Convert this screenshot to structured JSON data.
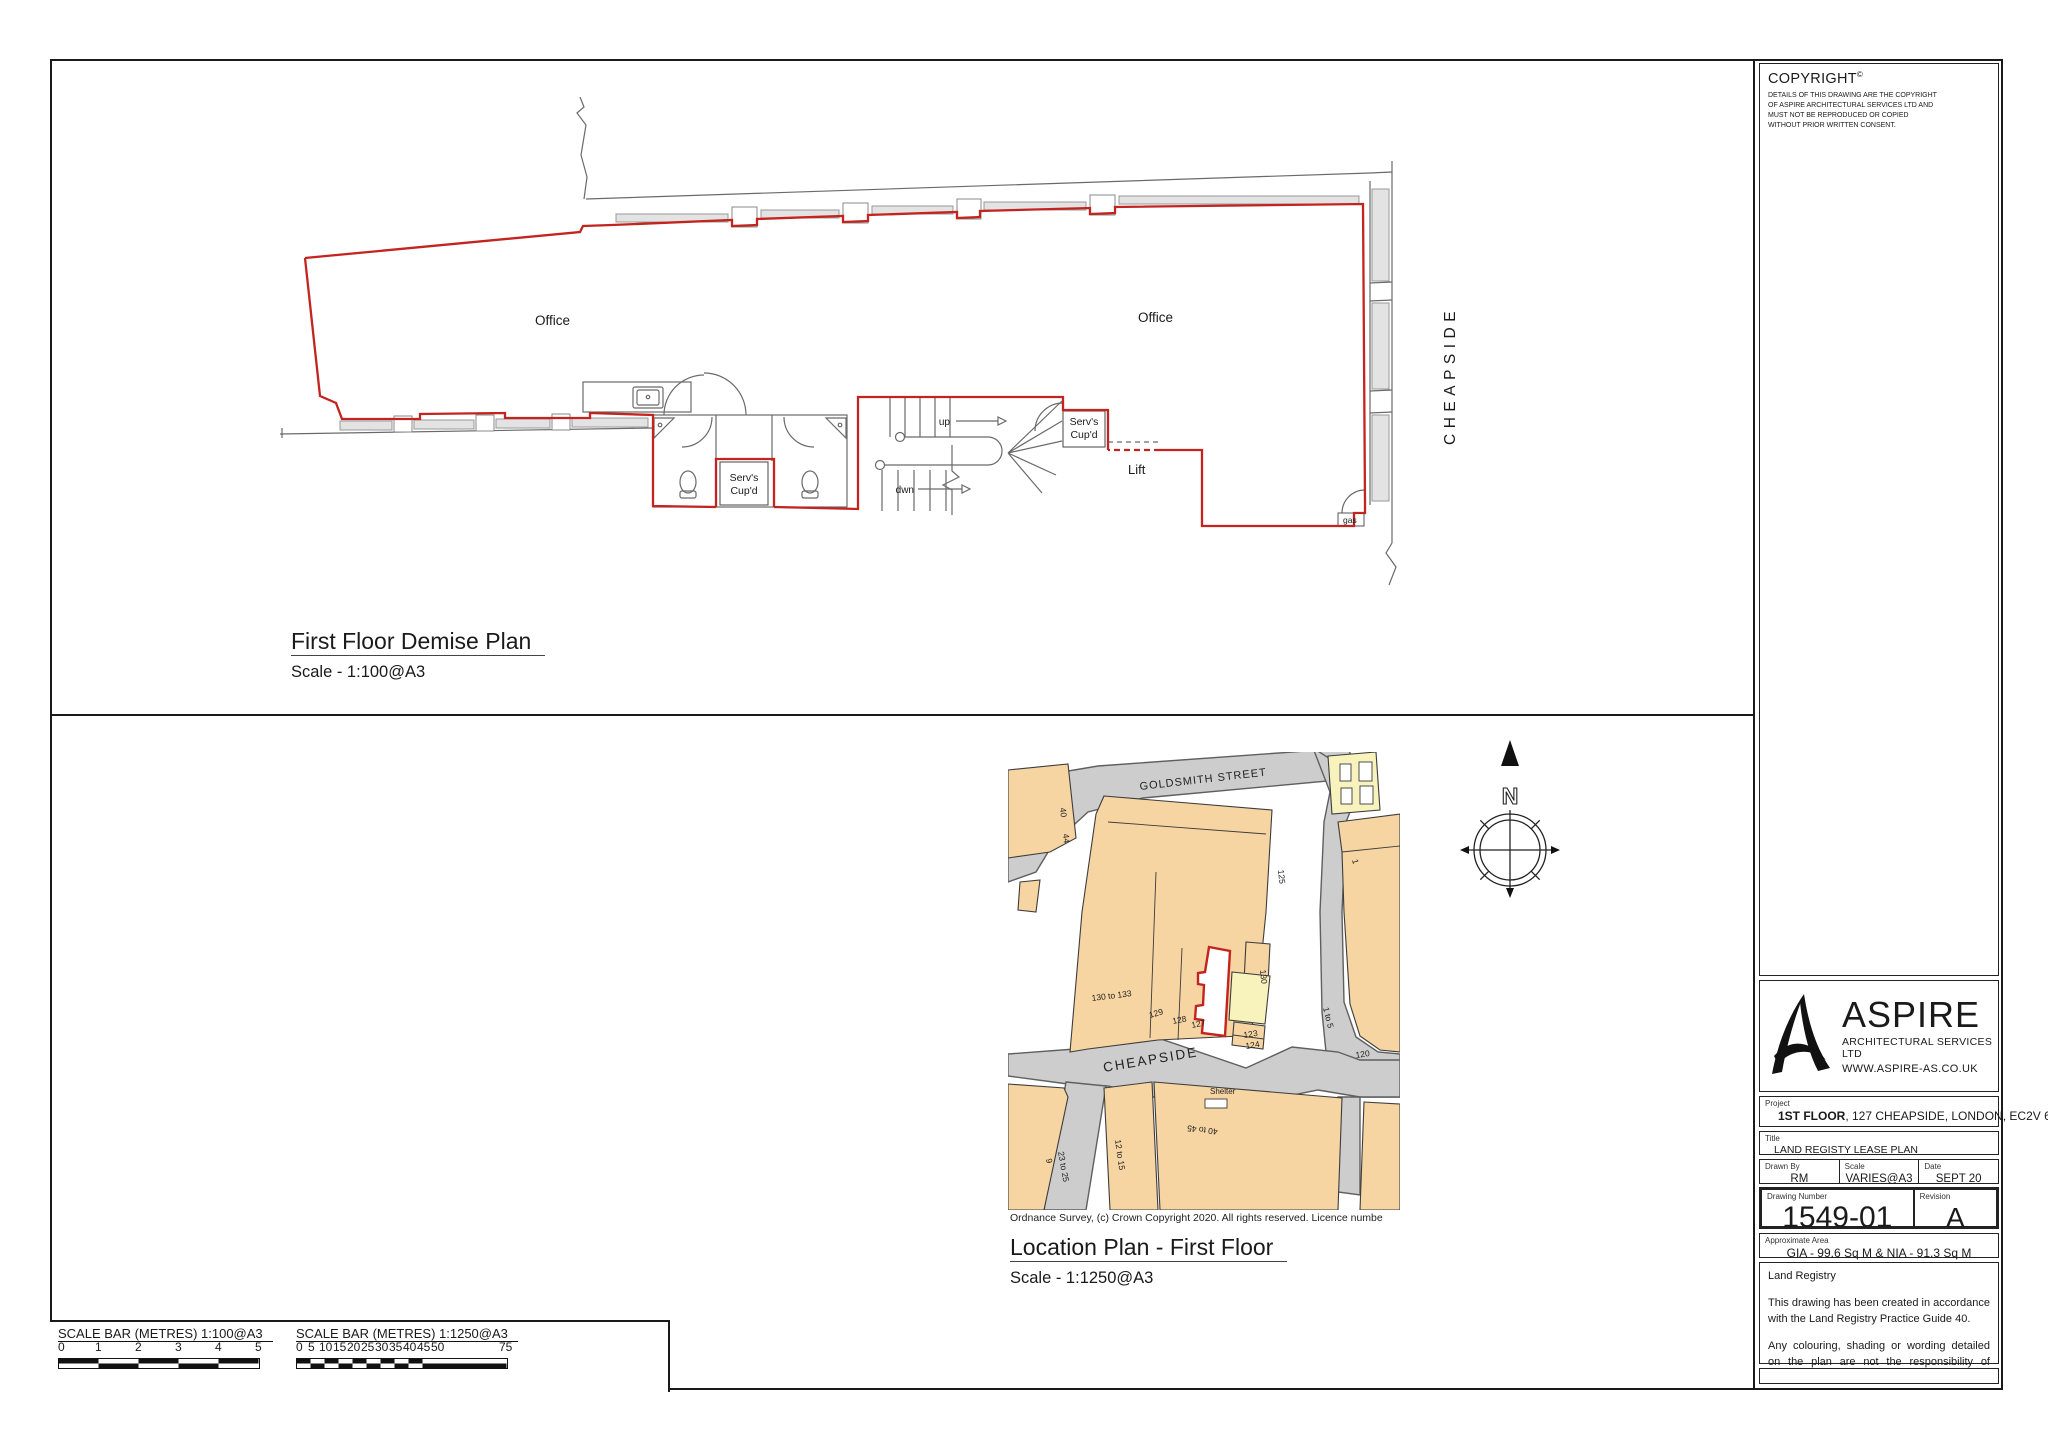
{
  "copyright": {
    "title": "COPYRIGHT",
    "sup": "©",
    "body": "DETAILS OF THIS DRAWING ARE THE COPYRIGHT OF ASPIRE ARCHITECTURAL SERVICES LTD AND MUST NOT BE REPRODUCED OR COPIED WITHOUT PRIOR WRITTEN CONSENT."
  },
  "demise_plan": {
    "title": "First Floor Demise Plan",
    "scale": "Scale - 1:100@A3",
    "labels": {
      "office_left": "Office",
      "office_right": "Office",
      "servs_left_line1": "Serv's",
      "servs_left_line2": "Cup'd",
      "servs_right_line1": "Serv's",
      "servs_right_line2": "Cup'd",
      "lift": "Lift",
      "up": "up",
      "dwn": "dwn",
      "gas": "gas",
      "street": "CHEAPSIDE"
    }
  },
  "location_plan": {
    "title": "Location Plan - First Floor",
    "scale": "Scale - 1:1250@A3",
    "credit": "Ordnance Survey, (c) Crown Copyright 2020. All rights reserved. Licence numbe",
    "north": "N",
    "streets": {
      "goldsmith": "GOLDSMITH STREET",
      "cheapside": "CHEAPSIDE"
    },
    "labels": {
      "n40": "40",
      "n44": "44",
      "n125": "125",
      "n1": "1",
      "n130": "130",
      "n130to133": "130 to 133",
      "n129": "129",
      "n128": "128",
      "n127": "127",
      "n123": "123",
      "n124": "124",
      "n1to5": "1 to 5",
      "n120": "120",
      "shelter": "Shelter",
      "n40to45": "40 to 45",
      "n12to15": "12 to 15",
      "n9": "9",
      "n23to25": "23 to 25"
    }
  },
  "title_block": {
    "logo": {
      "name": "ASPIRE",
      "subtitle": "ARCHITECTURAL SERVICES LTD",
      "website": "WWW.ASPIRE-AS.CO.UK"
    },
    "project": {
      "label": "Project",
      "bold": "1ST FLOOR",
      "rest": ", 127 CHEAPSIDE, LONDON, EC2V 6BT"
    },
    "title": {
      "label": "Title",
      "value": "LAND REGISTY LEASE PLAN"
    },
    "drawn_by": {
      "label": "Drawn By",
      "value": "RM"
    },
    "scale": {
      "label": "Scale",
      "value": "VARIES@A3"
    },
    "date": {
      "label": "Date",
      "value": "SEPT 20"
    },
    "drawing_number": {
      "label": "Drawing Number",
      "value": "1549-01"
    },
    "revision": {
      "label": "Revision",
      "value": "A"
    },
    "approx_area": {
      "label": "Approximate Area",
      "value": "GIA - 99.6 Sq M & NIA - 91.3 Sq M"
    },
    "notes": {
      "heading": "Land Registry",
      "para1": "This drawing has been created in accordance with the Land Registry Practice Guide 40.",
      "para2": "Any colouring, shading or wording detailed on the plan are not the responsibility of Aspire Architectural Services Ltd."
    }
  },
  "scale_bars": {
    "bar1": {
      "title": "SCALE BAR (METRES) 1:100@A3",
      "ticks": [
        "0",
        "1",
        "2",
        "3",
        "4",
        "5"
      ]
    },
    "bar2": {
      "title": "SCALE BAR (METRES) 1:1250@A3",
      "ticks": [
        "0",
        "5",
        "10",
        "15",
        "20",
        "25",
        "30",
        "35",
        "40",
        "45",
        "50",
        "75"
      ]
    }
  },
  "colors": {
    "demise_red": "#c3241f",
    "map_building": "#f6d5a2",
    "map_building_alt": "#f8f2bd",
    "map_road": "#cdcdcd",
    "drawing_line": "#6a6a6a"
  }
}
